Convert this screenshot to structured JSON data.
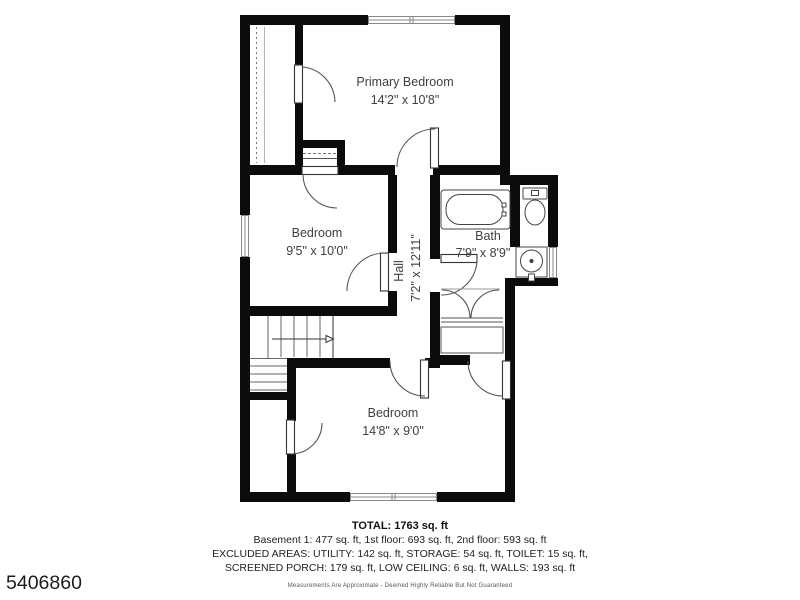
{
  "colors": {
    "wall": "#0b0b0b",
    "line": "#555555",
    "text": "#3f3f3f"
  },
  "floorplan": {
    "rooms": [
      {
        "id": "primary-bedroom",
        "label": "Primary Bedroom",
        "dims": "14'2\" x 10'8\""
      },
      {
        "id": "bedroom-2",
        "label": "Bedroom",
        "dims": "9'5\" x 10'0\""
      },
      {
        "id": "hall",
        "label": "Hall",
        "dims": "7'2\" x 12'11\""
      },
      {
        "id": "bath",
        "label": "Bath",
        "dims": "7'9\" x 8'9\""
      },
      {
        "id": "bedroom-3",
        "label": "Bedroom",
        "dims": "14'8\" x 9'0\""
      }
    ],
    "fixtures": [
      "bathtub",
      "toilet",
      "sink",
      "stairs",
      "closet-shelf",
      "bifold-closet"
    ]
  },
  "summary": {
    "total": "TOTAL: 1763 sq. ft",
    "floors": "Basement 1: 477 sq. ft, 1st floor: 693 sq. ft, 2nd floor: 593 sq. ft",
    "excluded_line1": "EXCLUDED AREAS: UTILITY: 142 sq. ft, STORAGE: 54 sq. ft, TOILET: 15 sq. ft,",
    "excluded_line2": "SCREENED PORCH: 179 sq. ft, LOW CEILING: 6 sq. ft, WALLS: 193 sq. ft",
    "disclaimer": "Measurements Are Approximate - Deemed Highly Reliable But Not Guaranteed"
  },
  "listing_id": "5406860"
}
